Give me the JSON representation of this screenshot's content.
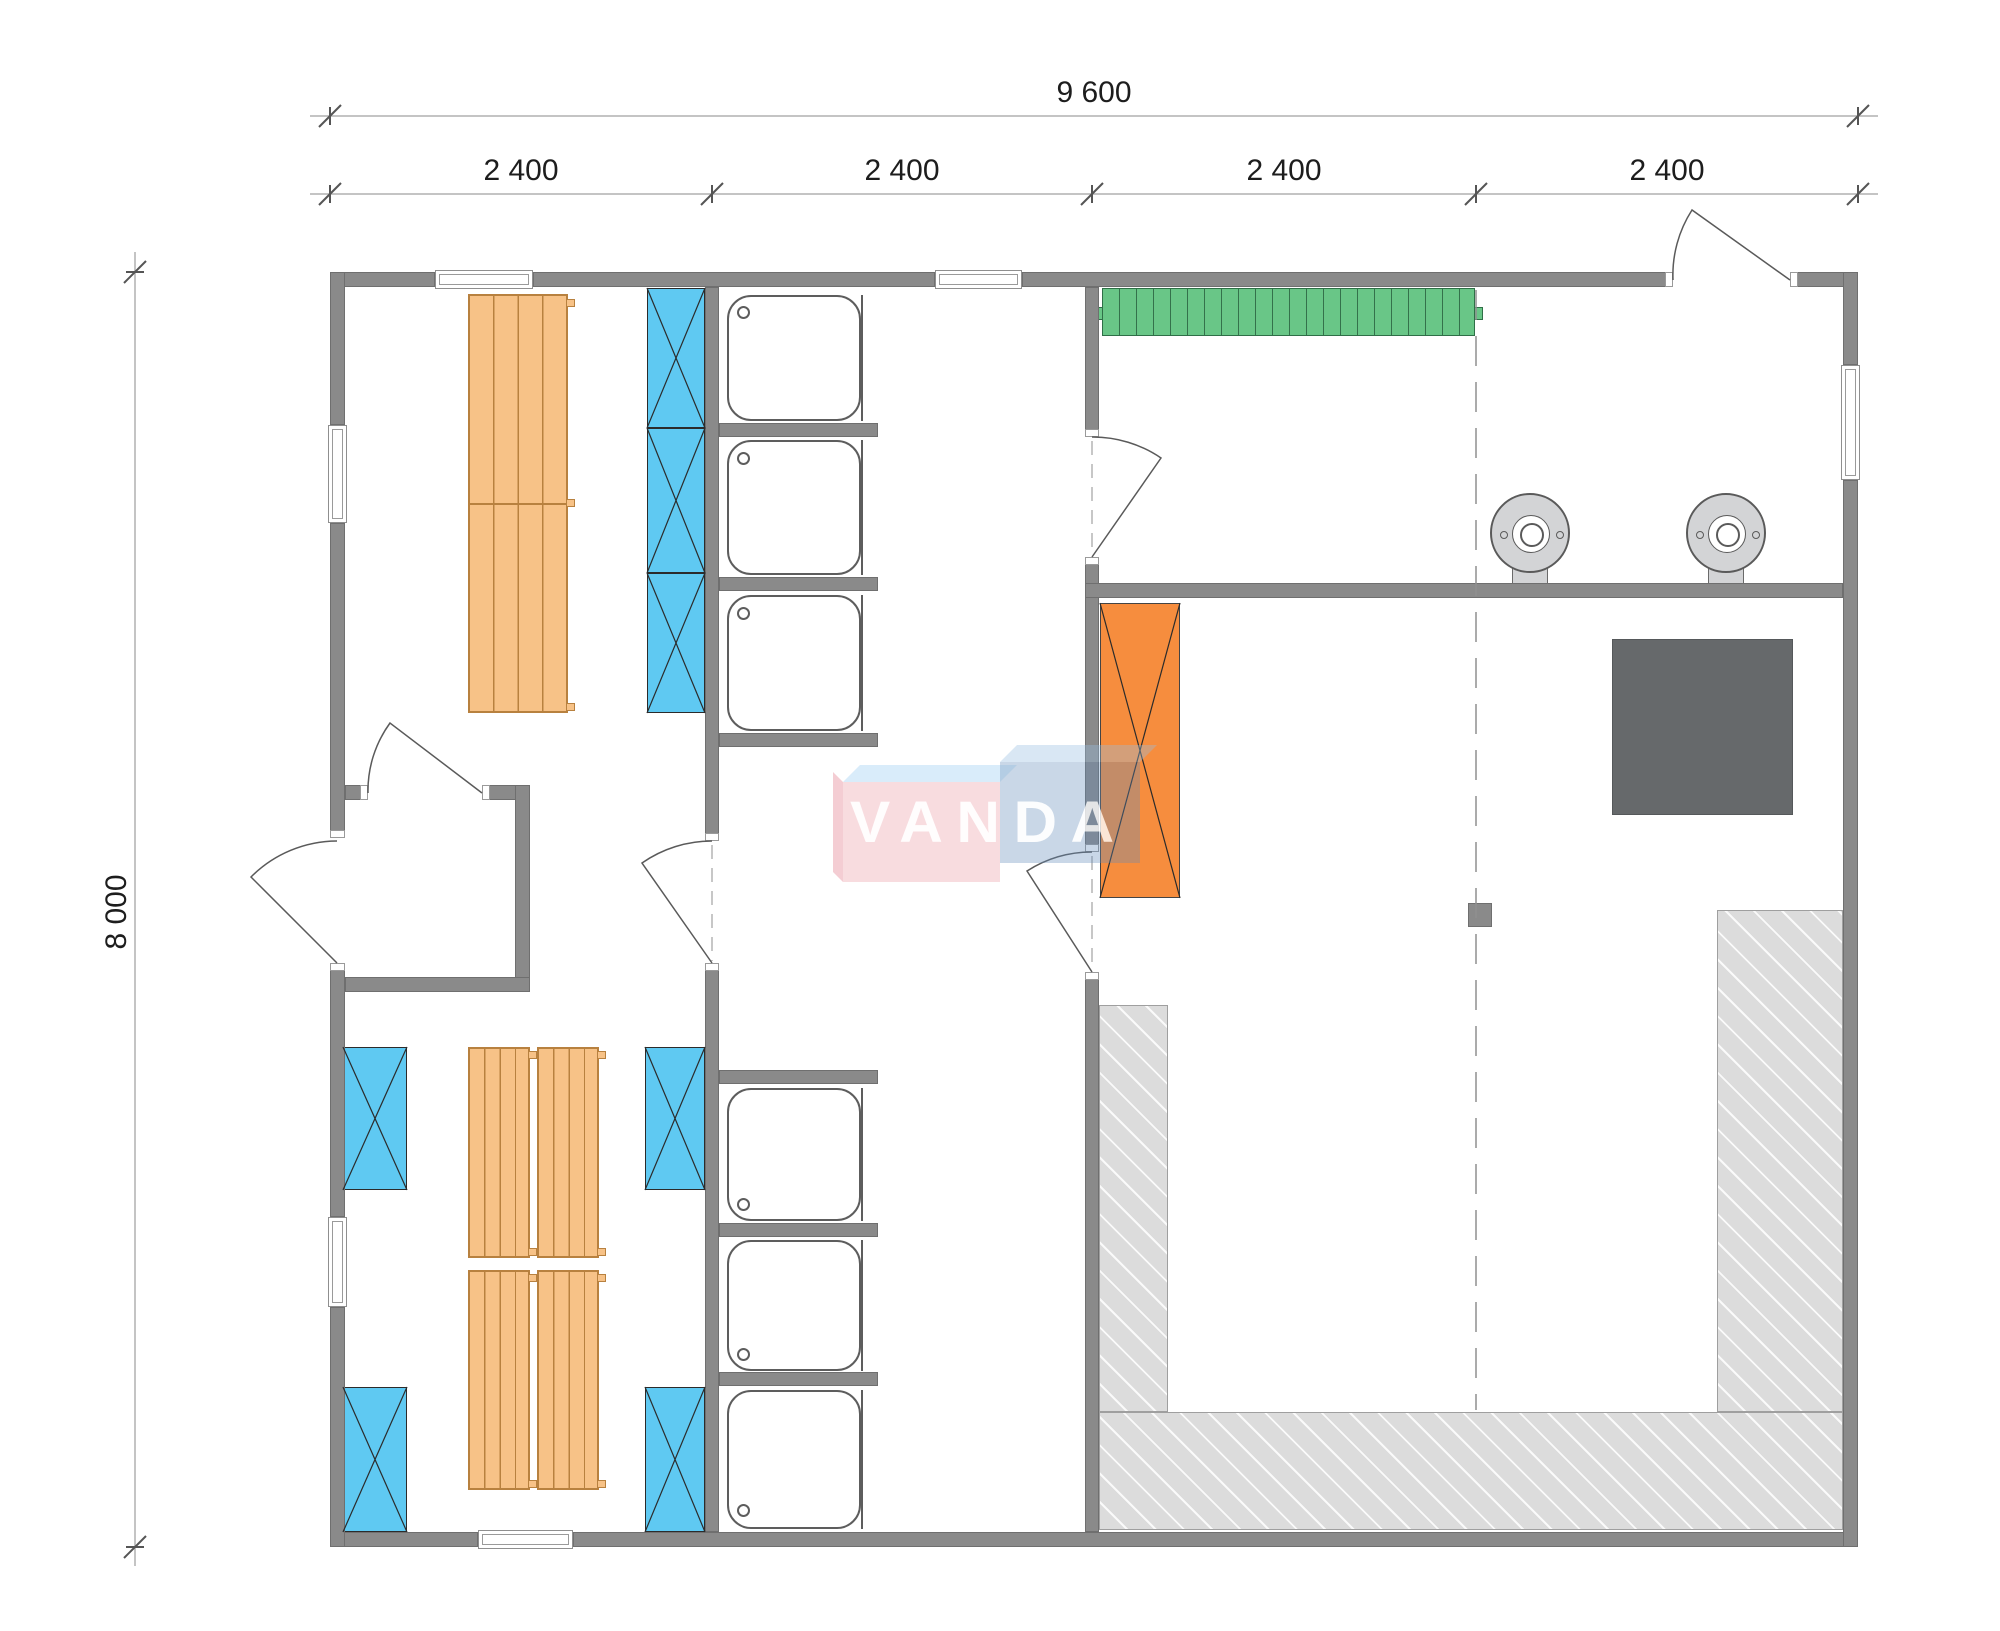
{
  "watermark": {
    "text": "VANDA"
  },
  "dimensions": {
    "width_total": "9 600",
    "width_modules": [
      "2 400",
      "2 400",
      "2 400",
      "2 400"
    ],
    "height_total": "8 000"
  },
  "colors": {
    "wall": "#8a8a8a",
    "wall-edge": "#6f6f6f",
    "bench": "#f7c287",
    "bench-edge": "#b8813f",
    "locker": "#5fc9f2",
    "locker-edge": "#2b2b2b",
    "rack": "#69c687",
    "rack-edge": "#2f6f47",
    "guard": "#f68d3e",
    "stove": "#66696b",
    "platform": "#dcdcdc",
    "platform-edge": "#9f9f9f",
    "fixture-line": "#5d5d5d",
    "dim-line": "#b0b0b0",
    "dim-tick": "#555555",
    "dim-text": "#1d1d1d",
    "logo-pink": "rgba(235,150,160,0.40)",
    "logo-pink-top": "rgba(140,200,240,0.40)",
    "logo-blue": "rgba(100,140,185,0.42)",
    "logo-blue-top": "rgba(150,190,225,0.45)"
  },
  "legend": [
    "exterior-wall",
    "interior-wall",
    "window",
    "door-swing",
    "changing-bench",
    "locker-unit",
    "shower-tray",
    "shower-drain",
    "coat-rack",
    "water-heater",
    "sauna-stove",
    "stove-guard",
    "sauna-platform",
    "section-line",
    "column"
  ]
}
